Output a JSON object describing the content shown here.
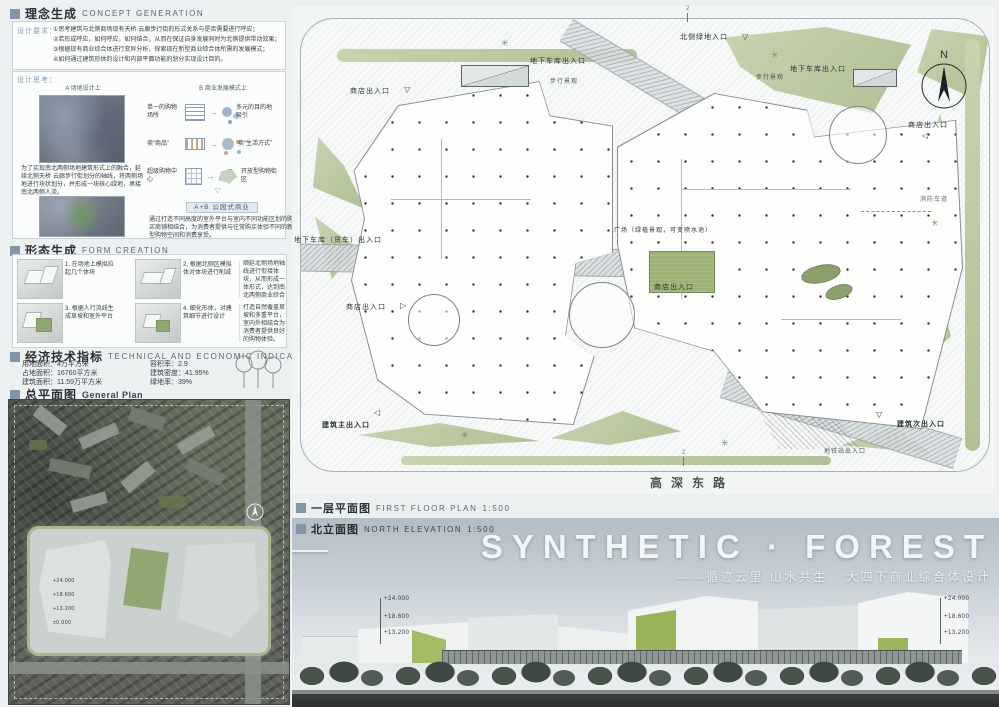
{
  "concept": {
    "title_zh": "理念生成",
    "title_en": "CONCEPT GENERATION",
    "requirements_label": "设计要求：",
    "requirements": [
      "①思考建筑与北侧商场现有天桥·云廊步行街的形式关系与是否需要进行呼应；",
      "②若形成呼应，如何呼应，如何结合，从而在保证自身发展同时为北侧提供带动效果；",
      "③根据现有商业综合体进行变异分析，探索现在新型商业综合体所需的发展模式；",
      "④如何通过建筑形体的设计和内部平面功能的划分实现设计目的。"
    ],
    "thinking_label": "设计思考：",
    "site_study": {
      "caption": "A 场地设计上",
      "text": "为了实现南北两侧场地建筑形式上的融合，延续北侧天桥·云廊步行街划分的轴线，将两侧场地进行块状划分，并形成一块核心绿地，承接南北两侧人流。"
    },
    "business_study": {
      "caption": "B 商业发展模式上",
      "rows": [
        {
          "from": "单一的购物场所",
          "to": "多元的目的地吸引"
        },
        {
          "from": "卖“商品”",
          "to": "卖“生活方式”"
        },
        {
          "from": "超级购物中心",
          "to": "开放型购物街区"
        }
      ]
    },
    "combo": {
      "tag": "A+B 公园式商业",
      "text": "通过打造不同高度的室外平台与室内不同功能区划的购买商铺相结合，为消费者提供与往常购买体验不同的新型购物空间和消费享受。"
    }
  },
  "form": {
    "title_zh": "形态生成",
    "title_en": "FORM CREATION",
    "steps": [
      {
        "num": "1.",
        "text": "在场地上模拟拉起几个体块"
      },
      {
        "num": "2.",
        "text": "根据北侧区模拟体对体块进行削减"
      },
      {
        "num": "3.",
        "text": "根据人行流线生成草坡和室外平台"
      },
      {
        "num": "4.",
        "text": "细化形体，对建筑细节进行设计"
      }
    ],
    "notes": [
      "顺延北侧场地轴线进行衔接体块，从而形成一体形式，达到南北两侧商业综合体和步行街融合发展的效果。",
      "打造自然覆盖草坡和多重平台，室内外相结合为消费者提供良好的购物体验。"
    ]
  },
  "indicators": {
    "title_zh": "经济技术指标",
    "title_en": "TECHNICAL AND ECONOMIC INDICATORS",
    "left": [
      "用地面积：4万平方米",
      "占地面积：16760平方米",
      "建筑面积：11.59万平方米"
    ],
    "right": [
      "容积率：2.9",
      "建筑密度：41.95%",
      "绿地率：39%"
    ]
  },
  "general_plan": {
    "title_zh": "总平面图",
    "title_en": "General Plan",
    "marks": [
      "+24.000",
      "+18.600",
      "+13.200",
      "±0.000"
    ]
  },
  "floor_plan": {
    "header": {
      "title_zh": "一层平面图",
      "title_en": "FIRST FLOOR PLAN",
      "scale": "1:500"
    },
    "labels": {
      "north_entrance": "北侧绿地入口",
      "garage": "地下车库出入口",
      "garage_truck": "地下车库（货车）出入口",
      "walk_landscape": "步行景观",
      "shop": "商店出入口",
      "plaza": "广场（绿植景观，可变喷水池）",
      "main_entrance": "建筑主出入口",
      "secondary_entrance": "建筑次出入口",
      "subway": "地铁站出入口",
      "fire_lane": "消防车道"
    },
    "road": "高深东路",
    "compass": "N",
    "section_mark": "2"
  },
  "elevation": {
    "header": {
      "title_zh": "北立面图",
      "title_en": "NORTH ELEVATION",
      "scale": "1:500"
    },
    "title": "SYNTHETIC · FOREST",
    "subtitle": "——循迹云里 山水共生 · 大四下商业综合体设计",
    "levels": [
      "+24.000",
      "+18.600",
      "+13.200"
    ]
  },
  "colors": {
    "accent": "#8196a9",
    "green": "#b7c6a0",
    "plaza_green": "#9cb277",
    "sky_top": "#b2bdc5",
    "dark_band": "#39413d"
  }
}
